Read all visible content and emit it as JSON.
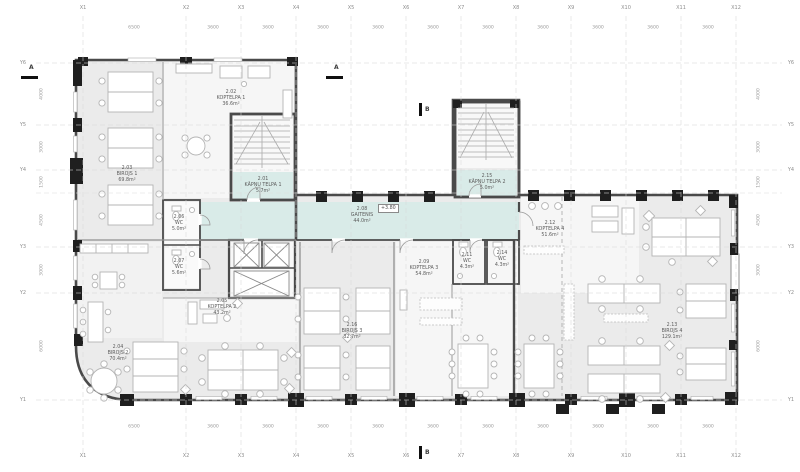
{
  "palette": {
    "office_fill": "#ebebeb",
    "communal_fill": "#f6f6f6",
    "corridor_fill": "#d9ebe8",
    "wall_color": "#4a4a4a",
    "pier_color": "#1f1f1f",
    "grid_color": "#d7d7d7"
  },
  "grid": {
    "x_labels": [
      {
        "id": "X1",
        "x": 83
      },
      {
        "id": "X2",
        "x": 186
      },
      {
        "id": "X3",
        "x": 241
      },
      {
        "id": "X4",
        "x": 296
      },
      {
        "id": "X5",
        "x": 351
      },
      {
        "id": "X6",
        "x": 406
      },
      {
        "id": "X7",
        "x": 461
      },
      {
        "id": "X8",
        "x": 516
      },
      {
        "id": "X9",
        "x": 571
      },
      {
        "id": "X10",
        "x": 626
      },
      {
        "id": "X11",
        "x": 681
      },
      {
        "id": "X12",
        "x": 736
      }
    ],
    "y_labels": [
      {
        "id": "Y6",
        "y": 63
      },
      {
        "id": "Y5",
        "y": 125
      },
      {
        "id": "Y4",
        "y": 170
      },
      {
        "id": "Y3",
        "y": 247
      },
      {
        "id": "Y2",
        "y": 293
      },
      {
        "id": "Y1",
        "y": 400
      }
    ],
    "dims_top": [
      {
        "v": "6500",
        "x": 134
      },
      {
        "v": "3600",
        "x": 213
      },
      {
        "v": "3600",
        "x": 268
      },
      {
        "v": "3600",
        "x": 323
      },
      {
        "v": "3600",
        "x": 378
      },
      {
        "v": "3600",
        "x": 433
      },
      {
        "v": "3600",
        "x": 488
      },
      {
        "v": "3600",
        "x": 543
      },
      {
        "v": "3600",
        "x": 598
      },
      {
        "v": "3600",
        "x": 653
      },
      {
        "v": "3600",
        "x": 708
      }
    ],
    "dims_bottom": [
      {
        "v": "6500",
        "x": 134
      },
      {
        "v": "3600",
        "x": 213
      },
      {
        "v": "3600",
        "x": 268
      },
      {
        "v": "3600",
        "x": 323
      },
      {
        "v": "3600",
        "x": 378
      },
      {
        "v": "3600",
        "x": 433
      },
      {
        "v": "3600",
        "x": 488
      },
      {
        "v": "3600",
        "x": 543
      },
      {
        "v": "3600",
        "x": 598
      },
      {
        "v": "3600",
        "x": 653
      },
      {
        "v": "3600",
        "x": 708
      }
    ],
    "dims_left": [
      {
        "v": "4000",
        "y": 94
      },
      {
        "v": "3000",
        "y": 147
      },
      {
        "v": "1500",
        "y": 182
      },
      {
        "v": "4500",
        "y": 220
      },
      {
        "v": "3000",
        "y": 270
      },
      {
        "v": "6000",
        "y": 346
      }
    ],
    "dims_right": [
      {
        "v": "4000",
        "y": 94
      },
      {
        "v": "3000",
        "y": 147
      },
      {
        "v": "1500",
        "y": 182
      },
      {
        "v": "4500",
        "y": 220
      },
      {
        "v": "3000",
        "y": 270
      },
      {
        "v": "6000",
        "y": 346
      }
    ]
  },
  "rooms": [
    {
      "number": "2.01",
      "name": "KĀPŅU TELPA 1",
      "area": "5.7m²",
      "x": 263,
      "y": 177
    },
    {
      "number": "2.02",
      "name": "KOPTELPA 1",
      "area": "36.6m²",
      "x": 231,
      "y": 90
    },
    {
      "number": "2.03",
      "name": "BIROJS 1",
      "area": "69.8m²",
      "x": 127,
      "y": 166
    },
    {
      "number": "2.04",
      "name": "BIROJS 2",
      "area": "70.4m²",
      "x": 118,
      "y": 345
    },
    {
      "number": "2.05",
      "name": "KOPTELPA 2",
      "area": "43.2m²",
      "x": 222,
      "y": 299
    },
    {
      "number": "2.06",
      "name": "WC",
      "area": "5.0m²",
      "x": 179,
      "y": 215
    },
    {
      "number": "2.07",
      "name": "WC",
      "area": "5.6m²",
      "x": 179,
      "y": 259
    },
    {
      "number": "2.08",
      "name": "GAITENIS",
      "area": "44.0m²",
      "x": 362,
      "y": 207
    },
    {
      "number": "2.09",
      "name": "KOPTELPA 3",
      "area": "54.8m²",
      "x": 424,
      "y": 260
    },
    {
      "number": "2.11",
      "name": "WC",
      "area": "4.3m²",
      "x": 467,
      "y": 253
    },
    {
      "number": "2.12",
      "name": "KOPTELPA 4",
      "area": "51.6m²",
      "x": 550,
      "y": 221
    },
    {
      "number": "2.13",
      "name": "BIROJS 4",
      "area": "129.1m²",
      "x": 672,
      "y": 323
    },
    {
      "number": "2.14",
      "name": "WC",
      "area": "4.3m²",
      "x": 502,
      "y": 251
    },
    {
      "number": "2.15",
      "name": "KĀPŅU TELPA 2",
      "area": "5.0m²",
      "x": 487,
      "y": 174
    },
    {
      "number": "2.16",
      "name": "BIROJS 3",
      "area": "32.7m²",
      "x": 352,
      "y": 323
    }
  ],
  "markers": {
    "section_a": "A",
    "section_b": "B",
    "elevation": "+3.80"
  }
}
